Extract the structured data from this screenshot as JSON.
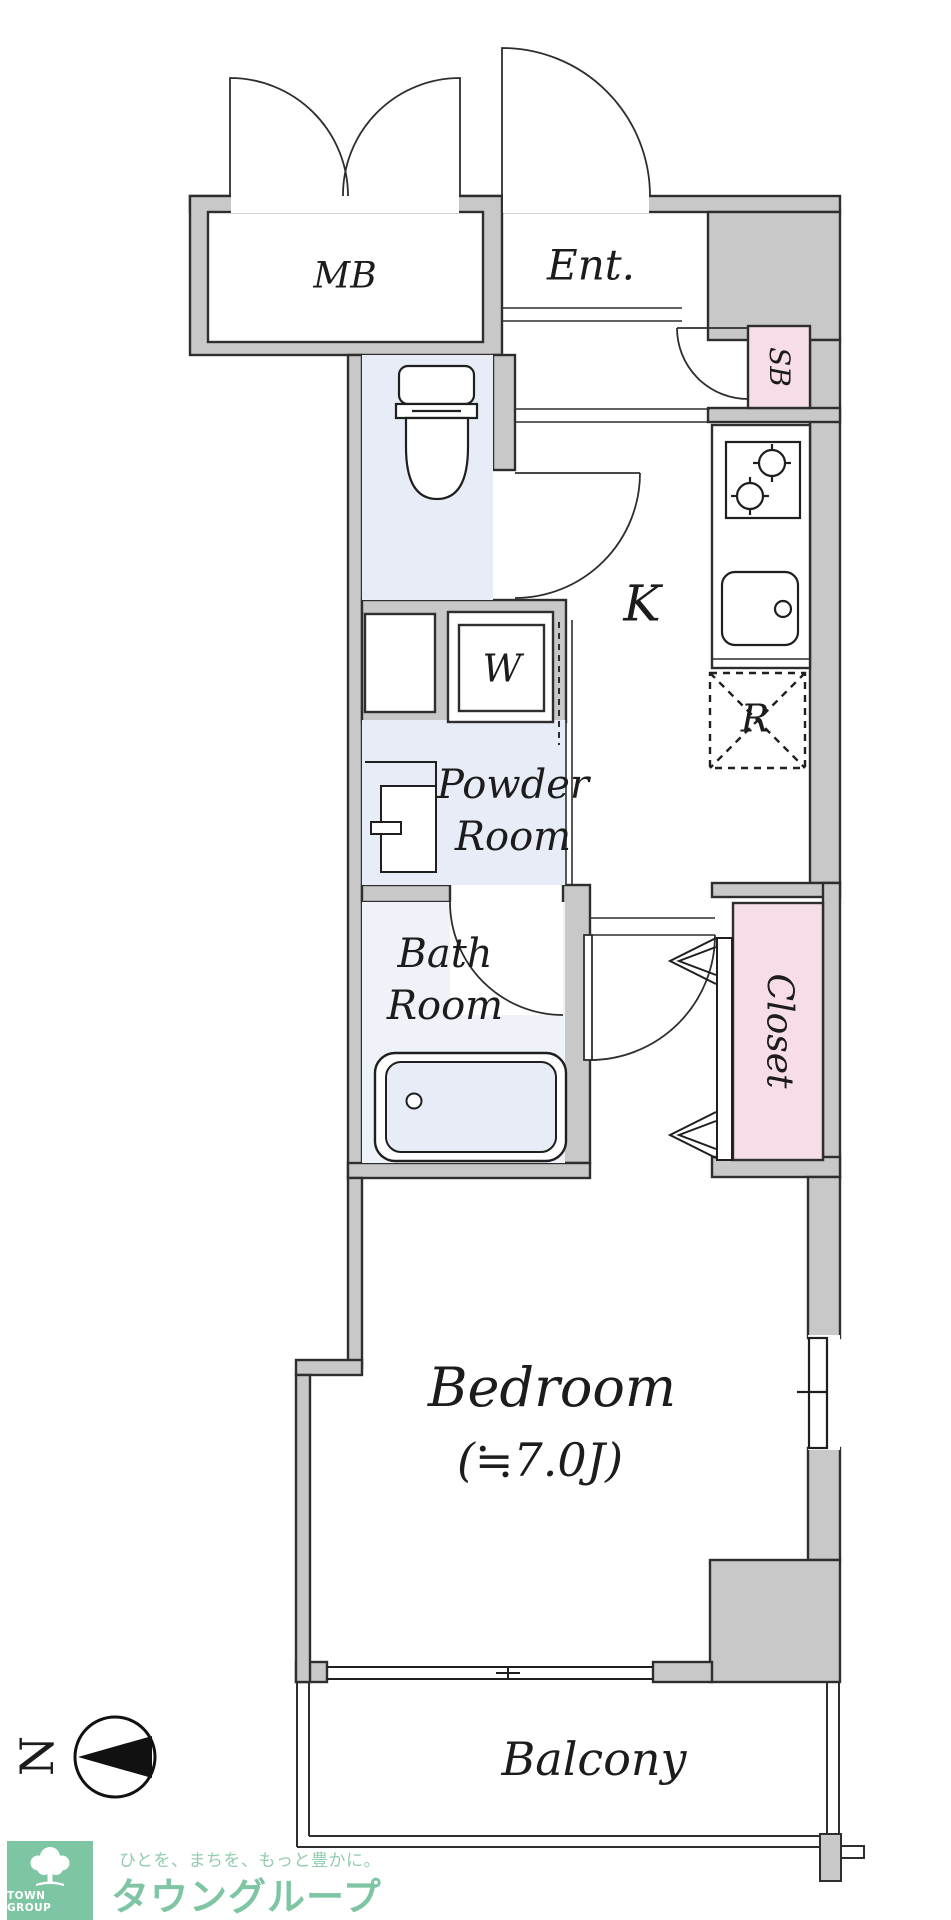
{
  "floorplan": {
    "colors": {
      "wall_gray": "#c8c8c8",
      "room_blue": "#e7ecf6",
      "bath_blue": "#eff2f9",
      "accent_pink": "#f7dde8",
      "line_dark": "#2e2e2e"
    },
    "labels": {
      "mb": "MB",
      "entrance": "Ent.",
      "shoe_box": "SB",
      "kitchen": "K",
      "washer": "W",
      "refrigerator": "R",
      "powder_room_line1": "Powder",
      "powder_room_line2": "Room",
      "bath_room_line1": "Bath",
      "bath_room_line2": "Room",
      "closet": "Closet",
      "bedroom": "Bedroom",
      "bedroom_size": "(≒7.0J)",
      "balcony": "Balcony"
    },
    "compass": {
      "north_label": "N"
    }
  },
  "footer": {
    "logo_text": "TOWN GROUP",
    "tagline": "ひとを、まちを、もっと豊かに。",
    "brand_name": "タウングループ"
  }
}
